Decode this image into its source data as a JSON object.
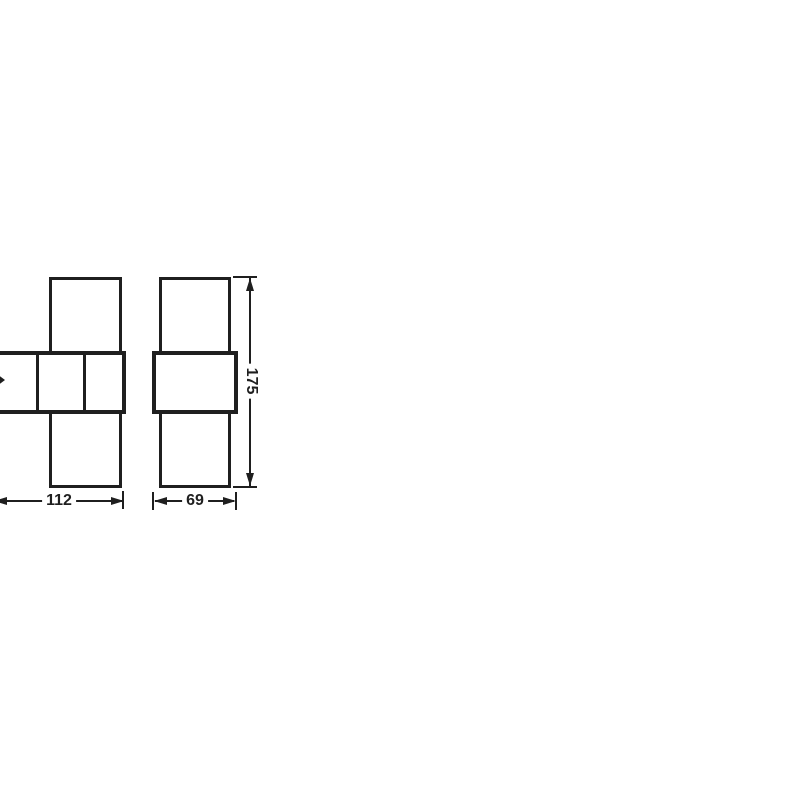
{
  "drawing": {
    "type": "product-dimension-diagram",
    "views": {
      "front": {
        "description": "front view of up/down wall luminaire, partially cropped at left image edge",
        "width_label": "112"
      },
      "side": {
        "description": "side view of up/down wall luminaire",
        "depth_label": "69",
        "height_label": "175"
      }
    },
    "dimensions": {
      "front_width": "112",
      "side_depth": "69",
      "height": "175"
    },
    "colors": {
      "line": "#1f1f1f",
      "background": "#ffffff"
    }
  }
}
